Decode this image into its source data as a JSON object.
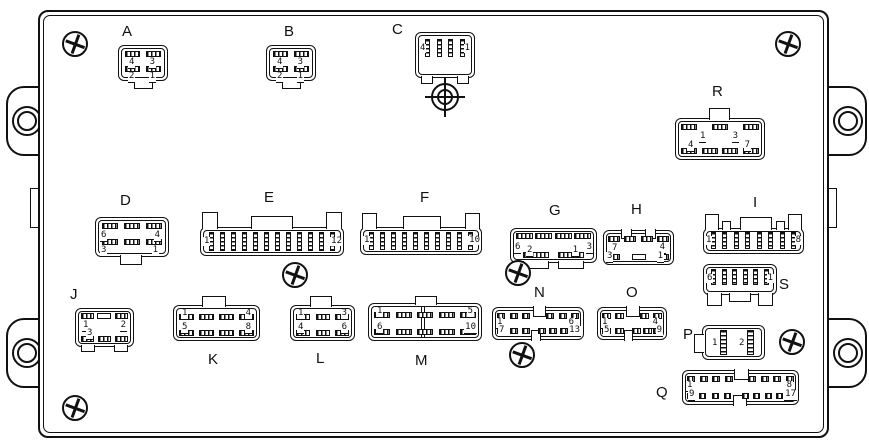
{
  "connectors": {
    "A": {
      "label": "A",
      "pin_tl": "4",
      "pin_tr": "3",
      "pin_bl": "2",
      "pin_br": "1"
    },
    "B": {
      "label": "B",
      "pin_tl": "4",
      "pin_tr": "3",
      "pin_bl": "2",
      "pin_br": "1"
    },
    "C": {
      "label": "C",
      "pin_left": "4",
      "pin_right": "1"
    },
    "D": {
      "label": "D",
      "pin_tl": "6",
      "pin_tr": "4",
      "pin_bl": "3",
      "pin_br": "1"
    },
    "E": {
      "label": "E",
      "pin_left": "1",
      "pin_right": "12"
    },
    "F": {
      "label": "F",
      "pin_left": "1",
      "pin_right": "10"
    },
    "G": {
      "label": "G",
      "pin_tl": "6",
      "pin_tr": "3",
      "pin_bl": "2",
      "pin_br": "1"
    },
    "H": {
      "label": "H",
      "pin_tl": "7",
      "pin_tr": "4",
      "pin_bl": "3",
      "pin_br": "1"
    },
    "I": {
      "label": "I",
      "pin_left": "1",
      "pin_right": "8"
    },
    "J": {
      "label": "J",
      "pin_tl": "1",
      "pin_tr": "2",
      "pin_bl": "3"
    },
    "K": {
      "label": "K",
      "pin_tl": "1",
      "pin_tr": "4",
      "pin_bl": "5",
      "pin_br": "8"
    },
    "L": {
      "label": "L",
      "pin_tl": "1",
      "pin_tr": "3",
      "pin_bl": "4",
      "pin_br": "6"
    },
    "M": {
      "label": "M",
      "pin_tl": "1",
      "pin_tr": "5",
      "pin_bl": "6",
      "pin_br": "10"
    },
    "N": {
      "label": "N",
      "pin_tl": "1",
      "pin_tr": "6",
      "pin_bl": "7",
      "pin_br": "13"
    },
    "O": {
      "label": "O",
      "pin_tl": "1",
      "pin_tr": "4",
      "pin_bl": "5",
      "pin_br": "9"
    },
    "P": {
      "label": "P",
      "pin_left": "1",
      "pin_right": "2"
    },
    "Q": {
      "label": "Q",
      "pin_tl": "1",
      "pin_tr": "8",
      "pin_bl": "9",
      "pin_br": "17"
    },
    "R": {
      "label": "R",
      "pin_tl": "1",
      "pin_tr": "3",
      "pin_bl": "4",
      "pin_br": "7"
    },
    "S": {
      "label": "S",
      "pin_left": "6",
      "pin_right": "1"
    }
  },
  "icons": {
    "screw": "phillips-screw",
    "target": "crosshair-alignment-target",
    "hole": "mounting-hole"
  },
  "colors": {
    "line": "#111111",
    "background": "#ffffff"
  }
}
